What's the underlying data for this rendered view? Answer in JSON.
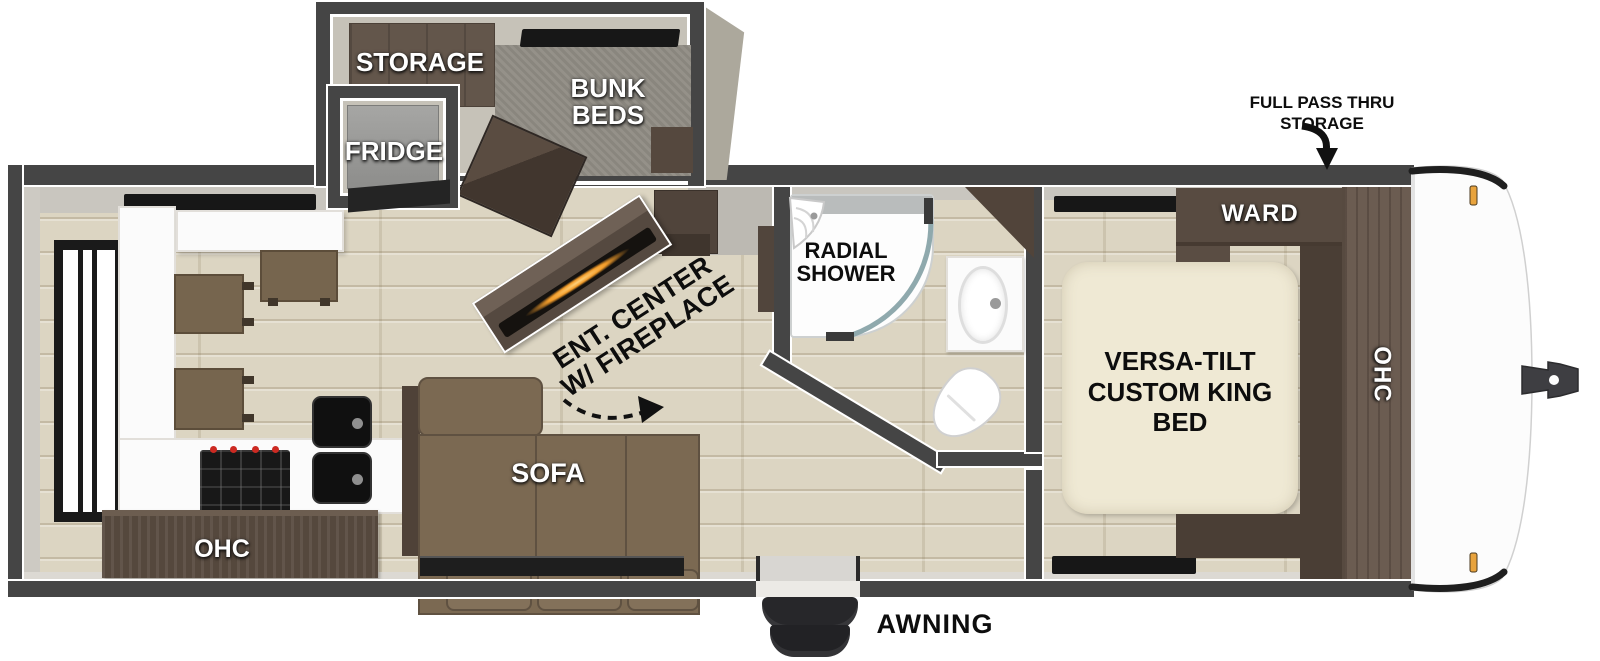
{
  "floorplan": {
    "labels": {
      "storage": "STORAGE",
      "bunk_beds": "BUNK BEDS",
      "fridge": "FRIDGE",
      "ent_center_fireplace": "ENT. CENTER W/ FIREPLACE",
      "radial_shower": "RADIAL SHOWER",
      "sofa": "SOFA",
      "kitchen_ohc": "OHC",
      "ward": "WARD",
      "bedroom_ohc": "OHC",
      "king_bed": "VERSA-TILT CUSTOM KING BED",
      "full_pass_thru_storage": "FULL PASS THRU STORAGE",
      "awning": "AWNING"
    },
    "colors": {
      "wall": "#454545",
      "floor": "#dcd5c2",
      "bunk_carpet": "#8f8b83",
      "cabinet_dark": "#4a3e35",
      "cabinet_wood": "#6b5c51",
      "sofa_brown": "#7b6952",
      "mattress_cream": "#efe9d4",
      "fireplace_glow": "#f29c2a",
      "marker_light": "#e8a33d",
      "fixture_white": "#fbfbfb"
    }
  }
}
